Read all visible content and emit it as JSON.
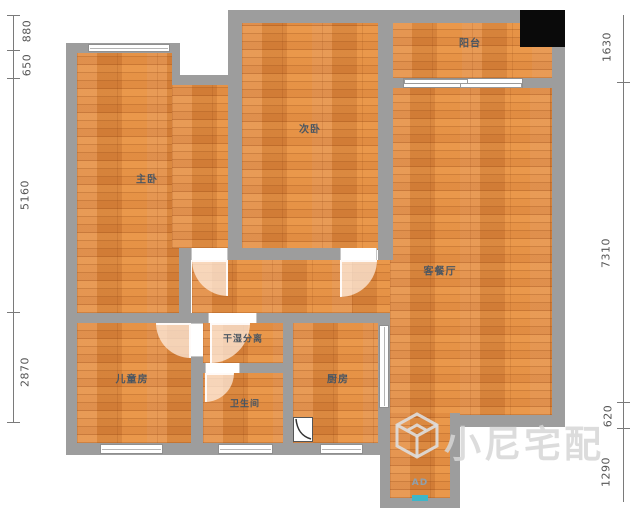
{
  "plan": {
    "rooms": {
      "master_bedroom": {
        "label": "主卧"
      },
      "second_bedroom": {
        "label": "次卧"
      },
      "balcony": {
        "label": "阳台"
      },
      "living_dining": {
        "label": "客餐厅"
      },
      "dry_wet_area": {
        "label": "干湿分离"
      },
      "bathroom": {
        "label": "卫生间"
      },
      "kitchen": {
        "label": "厨房"
      },
      "kids_room": {
        "label": "儿童房"
      }
    },
    "entry_label": "AD"
  },
  "dimensions": {
    "left": [
      "880",
      "650",
      "5160",
      "2870"
    ],
    "right": [
      "1630",
      "7310",
      "620",
      "1290"
    ]
  },
  "watermark": {
    "text": "小尼宅配"
  },
  "colors": {
    "wall": "#9d9d9d",
    "floor": "#e0873c",
    "room_label": "#4a5662",
    "dimension_text": "#555555",
    "entry_marker": "#3db6c9",
    "cover_block": "#0a0a0a"
  }
}
